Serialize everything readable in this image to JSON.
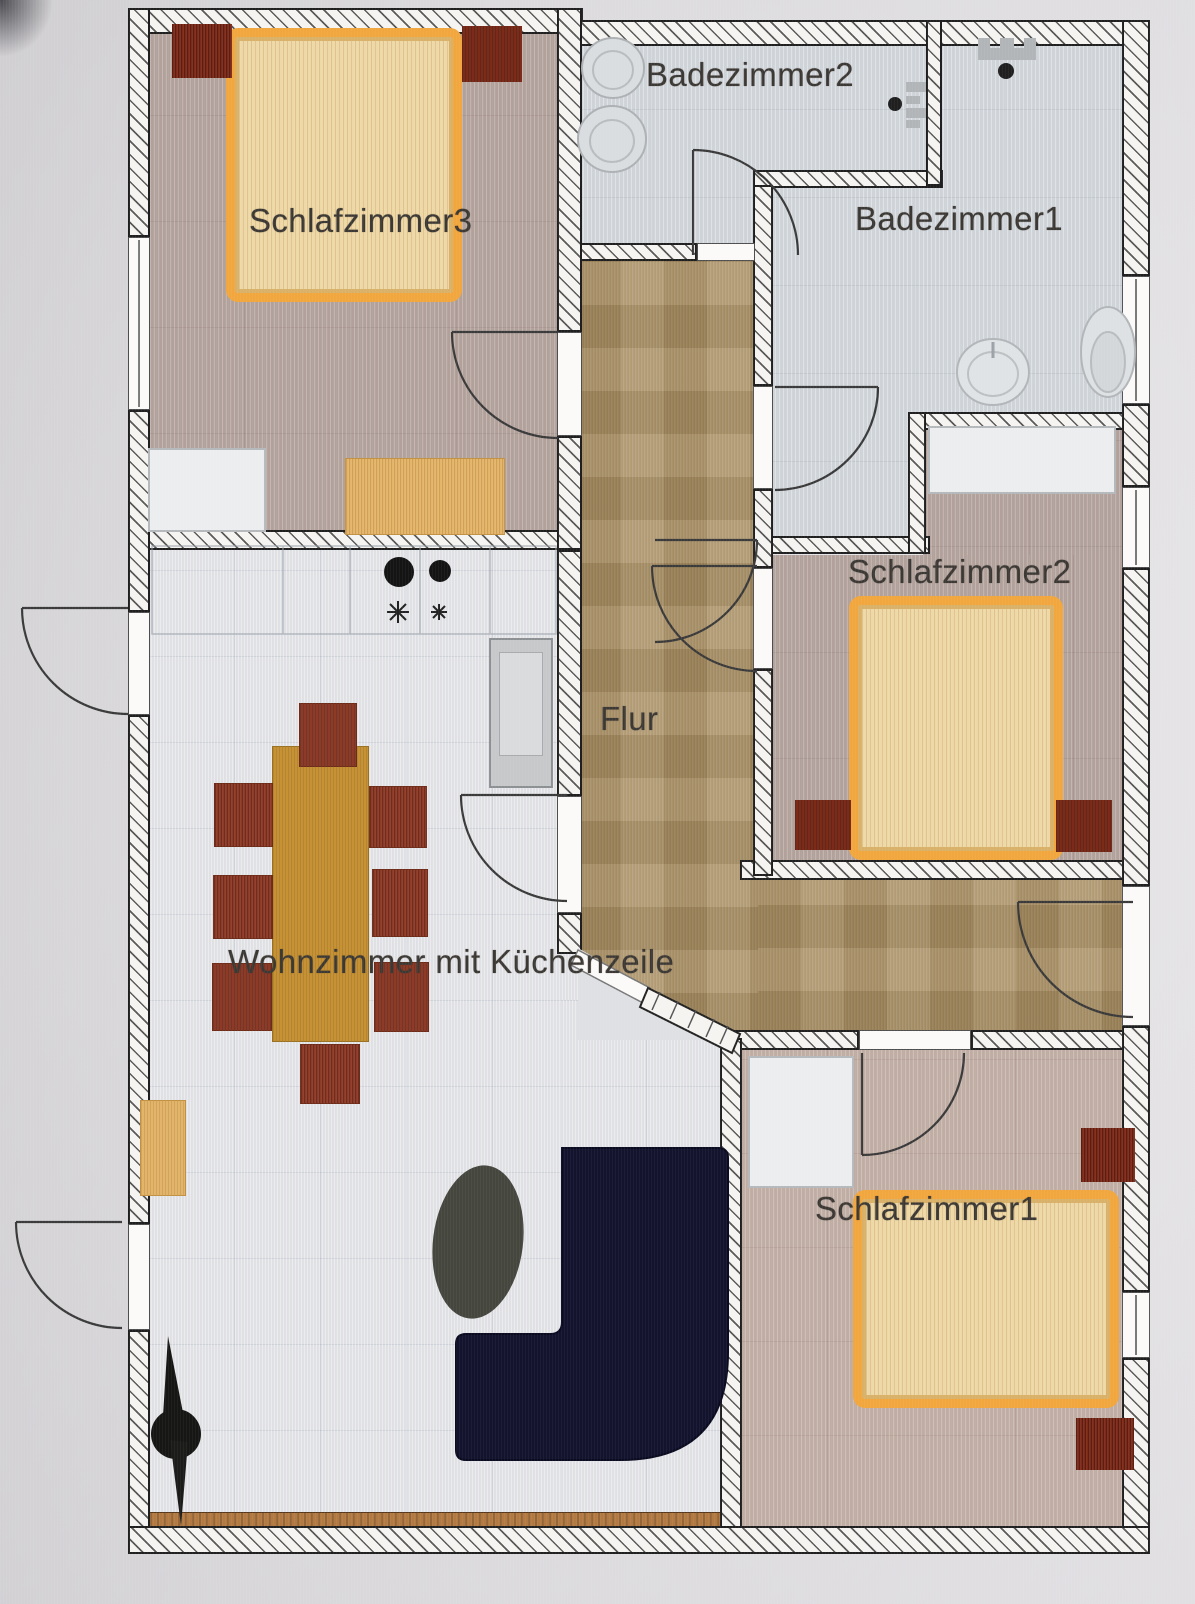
{
  "plan": {
    "type": "apartment-floor-plan",
    "rooms": {
      "schlafzimmer3": {
        "label": "Schlafzimmer3"
      },
      "badezimmer2": {
        "label": "Badezimmer2"
      },
      "badezimmer1": {
        "label": "Badezimmer1"
      },
      "schlafzimmer2": {
        "label": "Schlafzimmer2"
      },
      "flur": {
        "label": "Flur"
      },
      "wohnzimmer": {
        "label": "Wohnzimmer mit Küchenzeile"
      },
      "schlafzimmer1": {
        "label": "Schlafzimmer1"
      }
    },
    "colors": {
      "bed_frame": "#f1a63e",
      "bed_fill": "#eed8a7",
      "nightstand": "#7d2a19",
      "table": "#c69233",
      "chair": "#8d3a26",
      "sofa": "#13132e",
      "flur_tile": "#a68c60",
      "bedroom_floor": "#b2a19b",
      "bedroom1_floor": "#bfaca3",
      "bath_floor": "#ced3d8",
      "living_floor": "#dfe0e4",
      "wall_fill": "#f6f4f1",
      "accent_wood": "#b27a42"
    }
  }
}
